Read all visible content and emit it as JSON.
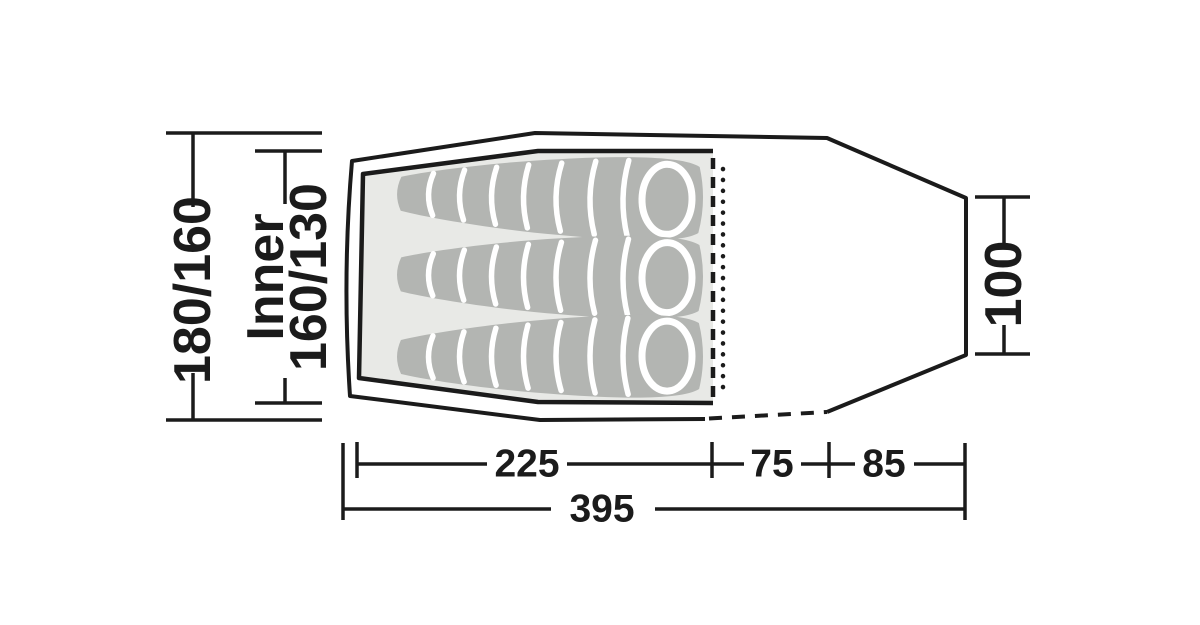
{
  "diagram_title": "tent-floorplan-dimensions",
  "labels": {
    "outer_width": "180/160",
    "inner_prefix": "Inner",
    "inner_width": "160/130",
    "door_height": "100",
    "inner_length": "225",
    "mid_length": "75",
    "front_length": "85",
    "total_length": "395"
  },
  "colors": {
    "line": "#1b1b1b",
    "inner-fill": "#e8e9e6",
    "bag-fill": "#b3b5b2",
    "stripe": "#ffffff",
    "background": "#ffffff"
  }
}
